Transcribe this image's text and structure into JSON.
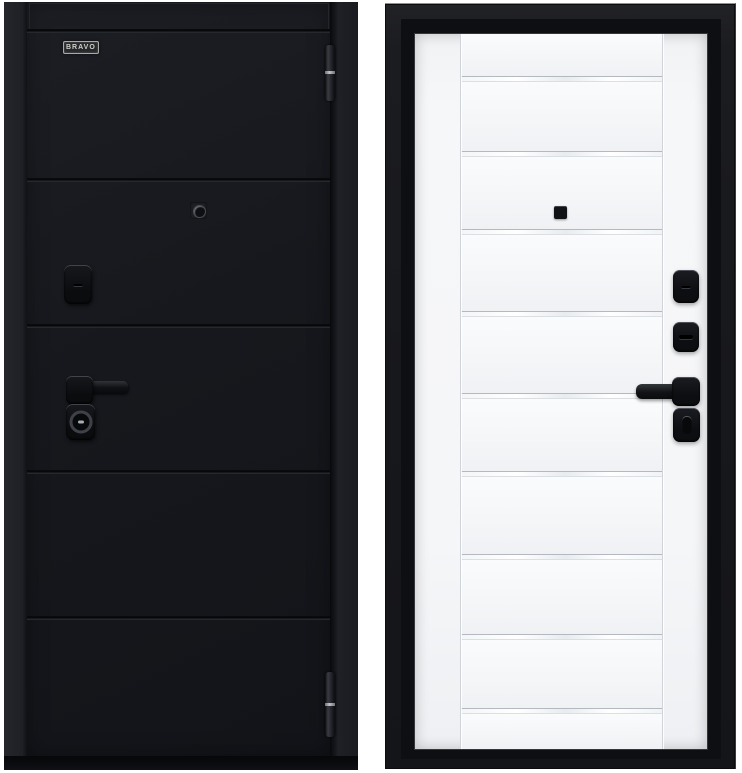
{
  "page": {
    "background": "#ffffff",
    "description": "Product photo of steel entry door, exterior and interior sides"
  },
  "product": {
    "brand_logo": "BRAVO",
    "exterior_door": {
      "finish": "black",
      "horizontal_grooves": 4,
      "hinge_count": 2,
      "hardware": [
        "keyhole-cover-escutcheon",
        "lever-handle",
        "cylinder-escutcheon",
        "peephole"
      ]
    },
    "interior_door": {
      "finish": "white",
      "glass_strip_count": 9,
      "vertical_stile_lines": 2,
      "hardware": [
        "escutcheon",
        "night-latch-escutcheon",
        "lever-handle",
        "thumbturn",
        "peephole"
      ]
    }
  },
  "colors": {
    "exterior_leaf": "#16181d",
    "exterior_frame": "#23252b",
    "interior_frame": "#17181c",
    "interior_leaf": "#f5f6f8",
    "hardware": "#0d0e11",
    "hinge_band": "#c0c3c8",
    "logo_silver": "#cfd1c4",
    "glass_strip": "#ffffff",
    "groove_line": "#b4b9bf"
  },
  "geometry": {
    "left_groove_y": [
      27,
      176,
      322,
      468,
      614
    ],
    "left_hinges": [
      {
        "top": 43,
        "height": 56
      },
      {
        "top": 670,
        "height": 65
      }
    ],
    "right_strip_y": [
      42,
      117,
      195,
      277,
      359,
      437,
      520,
      600,
      674
    ],
    "right_leaf_height": 715
  }
}
